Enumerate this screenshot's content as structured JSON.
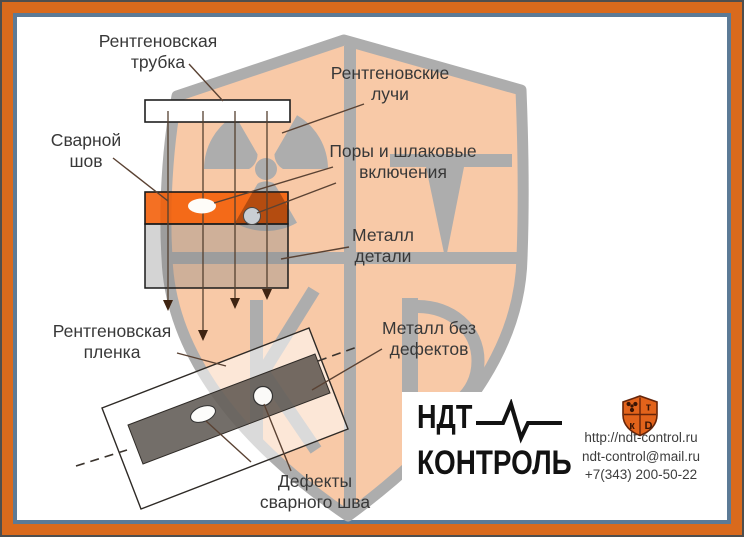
{
  "labels": {
    "xray_tube": {
      "line1": "Рентгеновская",
      "line2": "трубка"
    },
    "xray_rays": {
      "line1": "Рентгеновские",
      "line2": "лучи"
    },
    "weld_seam": {
      "line1": "Сварной",
      "line2": "шов"
    },
    "pores": {
      "line1": "Поры и шлаковые",
      "line2": "включения"
    },
    "metal_part": {
      "line1": "Металл",
      "line2": "детали"
    },
    "film": {
      "line1": "Рентгеновская",
      "line2": "пленка"
    },
    "metal_no_defects": {
      "line1": "Металл без",
      "line2": "дефектов"
    },
    "weld_defects": {
      "line1": "Дефекты",
      "line2": "сварного шва"
    }
  },
  "logo": {
    "name_line1": "НДТ",
    "name_line2": "КОНТРОЛЬ",
    "website": "http://ndt-control.ru",
    "email": "ndt-control@mail.ru",
    "phone": "+7(343) 200-50-22",
    "shield_glyphs": {
      "tr": "т",
      "bl": "к",
      "br": "D"
    }
  },
  "colors": {
    "frame_orange": "#D96A1D",
    "frame_slate": "#5C7A96",
    "weld_orange": "#F25C05",
    "watermark_gray": "#ADADAD",
    "watermark_fill": "#F8C9A7",
    "logo_shield_orange": "#E2631B"
  }
}
